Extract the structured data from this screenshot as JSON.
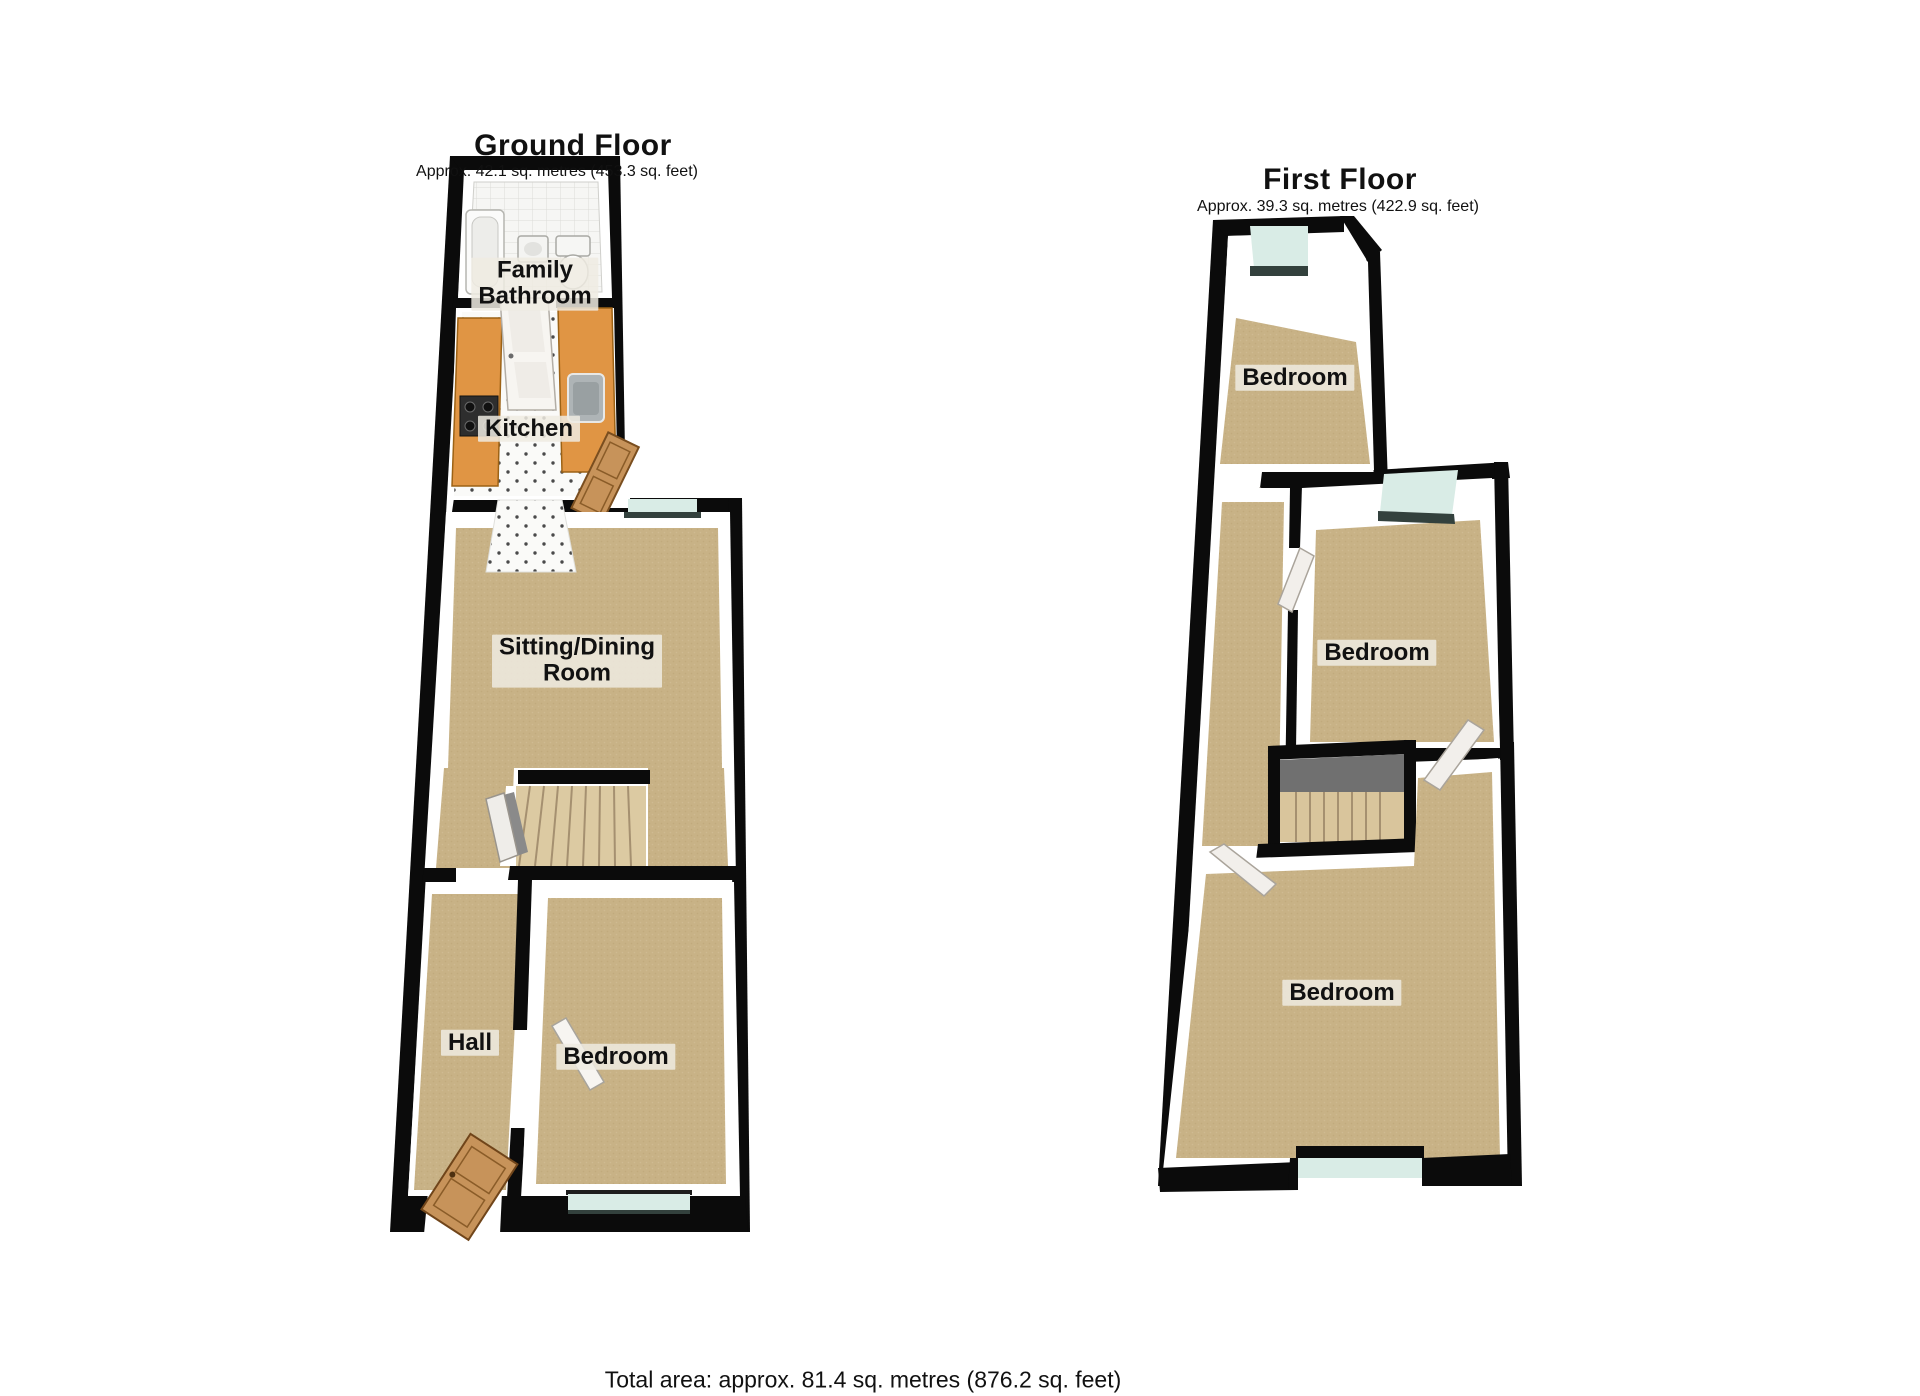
{
  "ground_floor": {
    "title": "Ground Floor",
    "subtitle": "Approx. 42.1 sq. metres (453.3 sq. feet)",
    "rooms": {
      "family_bathroom": "Family\nBathroom",
      "kitchen": "Kitchen",
      "sitting_dining": "Sitting/Dining\nRoom",
      "hall": "Hall",
      "bedroom": "Bedroom"
    }
  },
  "first_floor": {
    "title": "First Floor",
    "subtitle": "Approx. 39.3 sq. metres (422.9 sq. feet)",
    "rooms": {
      "bedroom_top": "Bedroom",
      "bedroom_middle": "Bedroom",
      "bedroom_bottom": "Bedroom"
    }
  },
  "footer": {
    "total_area": "Total area: approx. 81.4 sq. metres (876.2 sq. feet)"
  },
  "colors": {
    "wall": "#0b0b0b",
    "carpet": "#c8b286",
    "window_glass": "#d9ece6",
    "window_sill": "#33413d",
    "kitchen_counter": "#e09544",
    "wood_door": "#c7935a",
    "stair_tread": "#dccaa2",
    "stair_landing": "#707070",
    "tile_floor": "#f6f6f4"
  }
}
